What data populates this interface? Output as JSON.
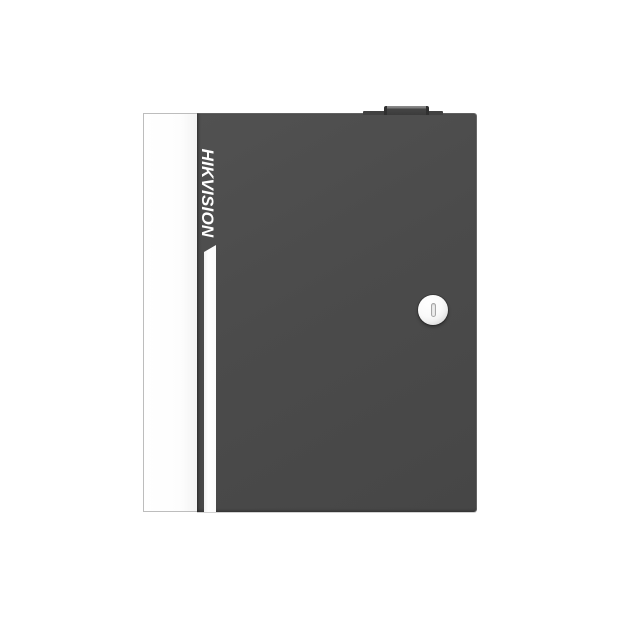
{
  "product_photo": {
    "subject": "wall-mount security controller enclosure, front view",
    "brand": {
      "label": "HIKVISION",
      "orientation": "vertical, rotated 90deg clockwise, reads top-to-bottom",
      "color": "#ffffff"
    },
    "parts": {
      "side_panel": "white left side face of cabinet",
      "front_door": "dark gray hinged front door",
      "accent_stripe": "white vertical stripe with slanted top, below logo",
      "cam_lock": "round silver key lock on right side of door",
      "keyhole_slot": "vertical key slot in lock center",
      "top_latch_tab": "small dark latch/hinge tab protruding from top edge"
    },
    "colors": {
      "background": "#ffffff",
      "door_gray": "#4b4b4b",
      "door_edge_highlight": "#6f6f6f",
      "side_panel_white": "#ffffff",
      "panel_border_gray": "#bdbdbd",
      "accent_stripe_white": "#fcfcfc",
      "latch_tab_dark": "#3b3b3b",
      "latch_tab_top": "#8d8d8d",
      "lock_face": "#f4f4f4",
      "lock_ring_shadow": "#989898",
      "keyslot_fill": "#ededed",
      "keyslot_outline": "#a6a6a6"
    }
  }
}
